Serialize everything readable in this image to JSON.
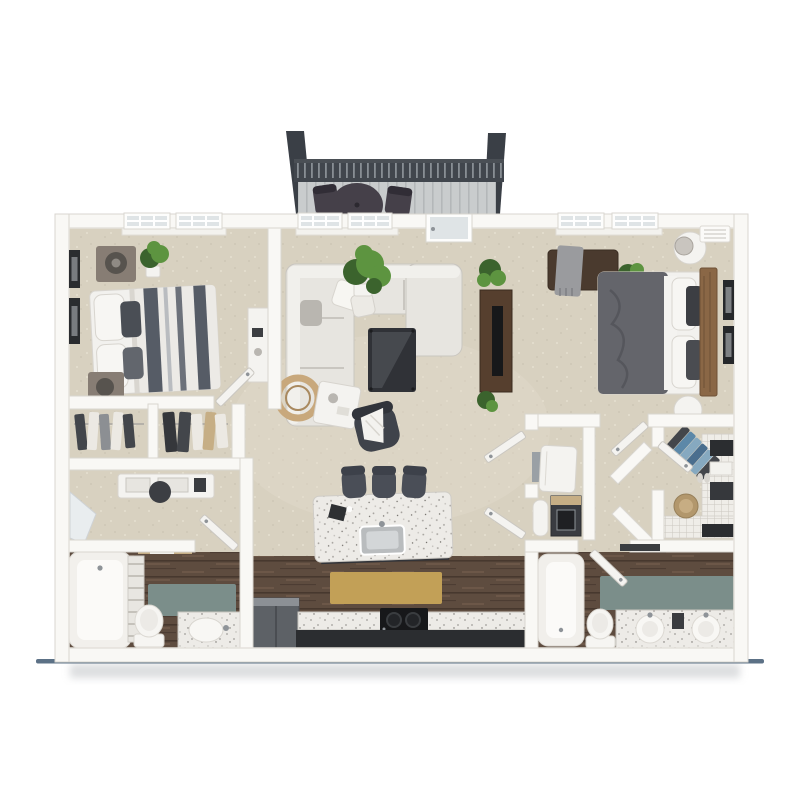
{
  "meta": {
    "type": "3d-floor-plan-rendering",
    "description": "Top-down 3D rendered floor plan of a two-bedroom two-bathroom apartment with balcony, open living room and kitchen island.",
    "visible_text": []
  },
  "colors": {
    "pageBg": "#ffffff",
    "wall": "#f9f8f5",
    "wallEdge": "#d9d6d0",
    "carpet": "#d8d1c0",
    "carpetLight": "#e4decd",
    "carpetDark": "#c7bfae",
    "wood": "#5e4c3f",
    "woodDark": "#47382e",
    "woodLight": "#7a6251",
    "teal": "#7b8e8a",
    "tanRug": "#c2a057",
    "granite": "#edebe7",
    "graniteDot": "#a19e99",
    "darkCab": "#2b2d30",
    "stool": "#4a4e57",
    "sofa": "#e7e5e0",
    "sofaEdge": "#c9c6c0",
    "furnWhite": "#f4f3f0",
    "furnWhiteEdge": "#d7d4ce",
    "bedWhite": "#f2f1ee",
    "stripeDark": "#565c66",
    "duvet2": "#64656b",
    "headboard": "#8a6746",
    "consoleWood": "#563f2e",
    "black": "#17181a",
    "metal": "#8e9398",
    "plant": "#5d9440",
    "plantDark": "#3b632d",
    "post": "#3a3f46",
    "rail": "#41464d",
    "railSlit": "#9aa0a6",
    "deck": "#c9cccd",
    "deckLine": "#b4b7b9",
    "balFurn": "#454049",
    "glass": "#dfe4e6",
    "mirror": "#e9edef",
    "fridge": "#5d6166",
    "shadowLine": "#5c7186",
    "shadowSoft": "#b9bcbf",
    "hamper": "#b2976c",
    "blue1": "#5c88a8",
    "blue2": "#86a9c0",
    "blue3": "#4a6e8e",
    "clothDark": "#43464b",
    "clothLight": "#ece9e3",
    "tanWood": "#c6ae85",
    "toilet": "#f6f5f2",
    "lampDark": "#57534e",
    "nstand": "#877d74"
  },
  "rooms": [
    {
      "id": "balcony",
      "label": "balcony",
      "items": [
        "corner-posts",
        "railing",
        "deck",
        "round-bistro-table",
        "two-chairs"
      ]
    },
    {
      "id": "bedroom-1",
      "label": "bedroom-1",
      "items": [
        "two-double-windows",
        "striped-queen-bed",
        "two-nightstands",
        "table-lamps",
        "wall-art-frames",
        "potted-plant",
        "white-desk"
      ]
    },
    {
      "id": "living-room",
      "label": "living-room",
      "items": [
        "double-window",
        "balcony-glass-door",
        "sectional-sofa",
        "throw-pillows",
        "coffee-table",
        "accent-chair-with-throw",
        "white-side-table",
        "round-woven-decor",
        "media-console",
        "potted-plants"
      ]
    },
    {
      "id": "bedroom-2",
      "label": "bedroom-2",
      "items": [
        "two-double-windows",
        "ac-vent",
        "bed-dark-duvet",
        "wood-headboard",
        "round-nightstands",
        "table-lamp",
        "bench-with-throw",
        "potted-plant",
        "wall-art-frames"
      ]
    },
    {
      "id": "closets-left",
      "label": "dressing-area",
      "items": [
        "two-closets-hanging-clothes",
        "white-dresser",
        "round-stool",
        "leaning-mirror"
      ]
    },
    {
      "id": "bathroom-1",
      "label": "bathroom-1",
      "items": [
        "bathtub",
        "towel-ladder",
        "teal-rug",
        "toilet",
        "vanity-with-sink",
        "wood-floor",
        "door"
      ]
    },
    {
      "id": "kitchen",
      "label": "kitchen",
      "items": [
        "granite-island-with-sink",
        "three-bar-stools",
        "tan-runner-rug",
        "refrigerator",
        "range-cooktop",
        "speckled-counter",
        "dark-base-cabinets",
        "wood-floor"
      ]
    },
    {
      "id": "hallway",
      "label": "hallway",
      "items": [
        "two-open-doors"
      ]
    },
    {
      "id": "utility-closet",
      "label": "utility-closet",
      "items": [
        "water-heater",
        "storage-cylinder",
        "dark-storage-box"
      ]
    },
    {
      "id": "walk-in-closet",
      "label": "walk-in-closet",
      "items": [
        "wire-shelving",
        "blue-hanging-clothes",
        "storage-bins",
        "folded-towels",
        "woven-hamper",
        "shoes",
        "door"
      ]
    },
    {
      "id": "bathroom-2",
      "label": "bathroom-2",
      "items": [
        "bathtub",
        "door",
        "teal-rug",
        "toilet",
        "double-vanity-two-sinks",
        "towel-bar",
        "wood-floor"
      ]
    }
  ]
}
